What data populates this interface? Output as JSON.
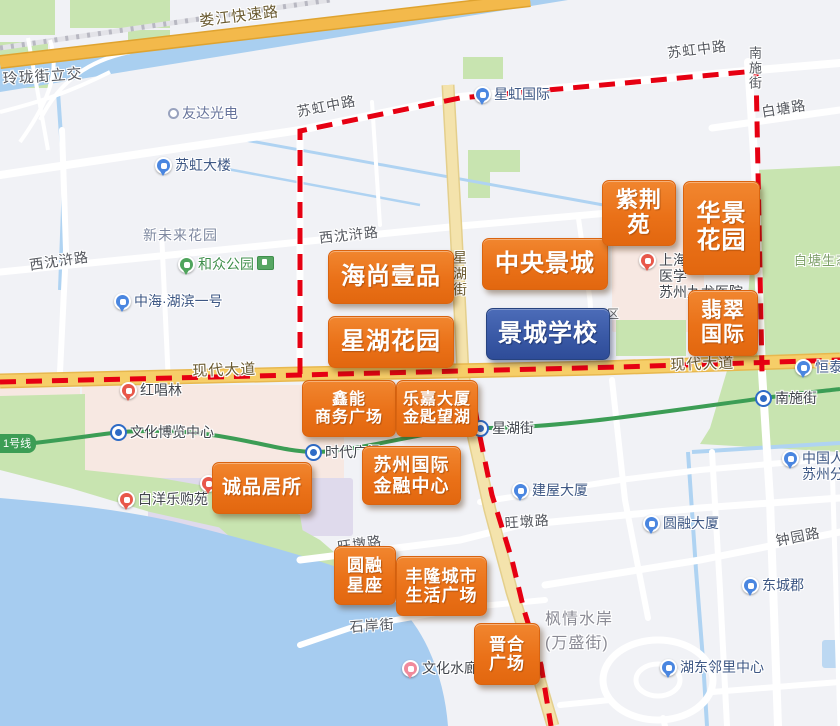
{
  "map": {
    "colors": {
      "estate_orange": "#EA7118",
      "estate_blue": "#3A59A6",
      "boundary_red": "#E60012",
      "road_yellow": "#F6CE68",
      "expressway_orange": "#F3B94B",
      "metro_green": "#3C9D55",
      "water_blue": "#A9CFF0",
      "park_green": "#C8E4B0"
    },
    "metro_badge": "1号线",
    "estates": [
      {
        "line1": "海尚壹品"
      },
      {
        "line1": "中央景城"
      },
      {
        "line1": "星湖花园"
      },
      {
        "line1": "景城学校",
        "kind": "blue-school"
      },
      {
        "line1": "紫荆",
        "line2": "苑"
      },
      {
        "line1": "华景",
        "line2": "花园"
      },
      {
        "line1": "翡翠",
        "line2": "国际"
      },
      {
        "line1": "鑫能",
        "line2": "商务广场"
      },
      {
        "line1": "乐嘉大厦",
        "line2": "金匙望湖"
      },
      {
        "line1": "苏州国际",
        "line2": "金融中心"
      },
      {
        "line1": "诚品居所"
      },
      {
        "line1": "圆融",
        "line2": "星座"
      },
      {
        "line1": "丰隆城市",
        "line2": "生活广场"
      },
      {
        "line1": "晋合",
        "line2": "广场"
      }
    ],
    "pois": [
      {
        "line1": "友达光电"
      },
      {
        "line1": "苏虹大楼"
      },
      {
        "line1": "和众公园"
      },
      {
        "line1": "中海·湖滨一号"
      },
      {
        "line1": "星虹国际"
      },
      {
        "line1": "上海",
        "line2": "医学",
        "line3": "苏州九龙医院"
      },
      {
        "line1": "红唱林"
      },
      {
        "line1": "文化博览中心"
      },
      {
        "line1": "时代广场"
      },
      {
        "line1": "星湖街"
      },
      {
        "line1": "建屋大厦"
      },
      {
        "line1": "圆融大厦"
      },
      {
        "line1": "东城郡"
      },
      {
        "line1": "湖东邻里中心"
      },
      {
        "line1": "南施街"
      },
      {
        "line1": "恒泰"
      },
      {
        "line1": "中国人寿",
        "line2": "苏州分公司"
      },
      {
        "line1": "文化水廊"
      },
      {
        "line1": "白洋乐购苑"
      }
    ],
    "road_labels": [
      "娄江快速路",
      "玲珑街立交",
      "苏虹中路",
      "苏虹中路",
      "南施街",
      "白塘路",
      "西沈浒路",
      "西沈浒路",
      "现代大道",
      "现代大道",
      "星湖街",
      "旺墩路",
      "旺墩路",
      "钟园路",
      "石岸街"
    ],
    "area_labels": [
      {
        "line1": "新未来花园"
      },
      {
        "line1": "枫情水岸",
        "line2": "(万盛街)"
      },
      {
        "line1": "白塘生态园"
      },
      {
        "line1": "区"
      }
    ]
  }
}
